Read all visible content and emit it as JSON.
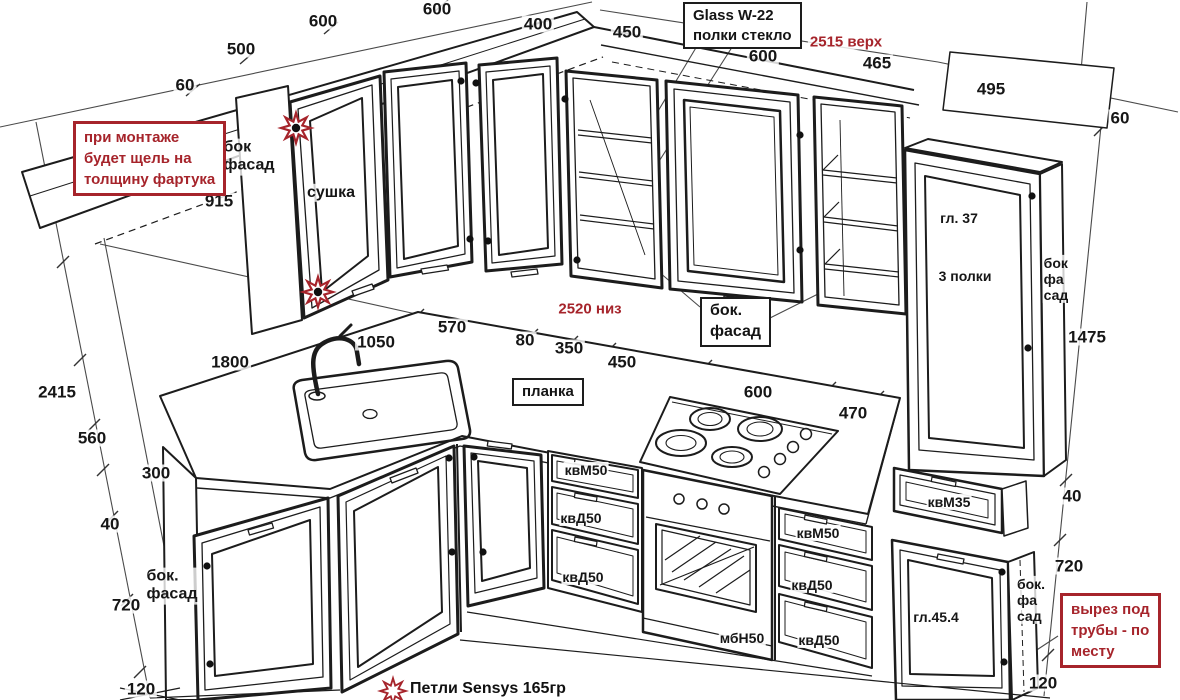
{
  "drawing": {
    "colors": {
      "line": "#1c1c1c",
      "red_accent": "#a6242b"
    },
    "notes": {
      "gap": [
        "при монтаже",
        "будет щель на",
        "толщину фартука"
      ],
      "pipes": [
        "вырез под",
        "трубы - по",
        "месту"
      ],
      "glass": [
        "Glass W-22",
        "полки стекло"
      ],
      "top_red": "2515 верх",
      "mid_red": "2520 низ",
      "hinges": "Петли  Sensys 165гр"
    },
    "labels": {
      "side_top": [
        "бок",
        "фасад"
      ],
      "dryer": "сушка",
      "depth37": "гл. 37",
      "shelves": "3 полки",
      "side_tall": [
        "бок",
        "фа",
        "сад"
      ],
      "side_mid": [
        "бок.",
        "фасад"
      ],
      "plank": "планка",
      "side_bl": [
        "бок.",
        "фасад"
      ],
      "side_br": [
        "бок.",
        "фа",
        "сад"
      ],
      "kvm50": "квМ50",
      "kvd50": "квД50",
      "kvm35": "квМ35",
      "mbn50": "мбН50",
      "gl454": "гл.45.4"
    },
    "dims": {
      "top": [
        "600",
        "500",
        "60",
        "600",
        "400",
        "450",
        "600",
        "465",
        "495",
        "60"
      ],
      "left": [
        "915",
        "2415",
        "560",
        "300",
        "40",
        "720",
        "120"
      ],
      "counter": [
        "1800",
        "1050",
        "570",
        "80",
        "350",
        "450",
        "600",
        "470"
      ],
      "right": [
        "1475",
        "40",
        "720",
        "120"
      ]
    }
  }
}
